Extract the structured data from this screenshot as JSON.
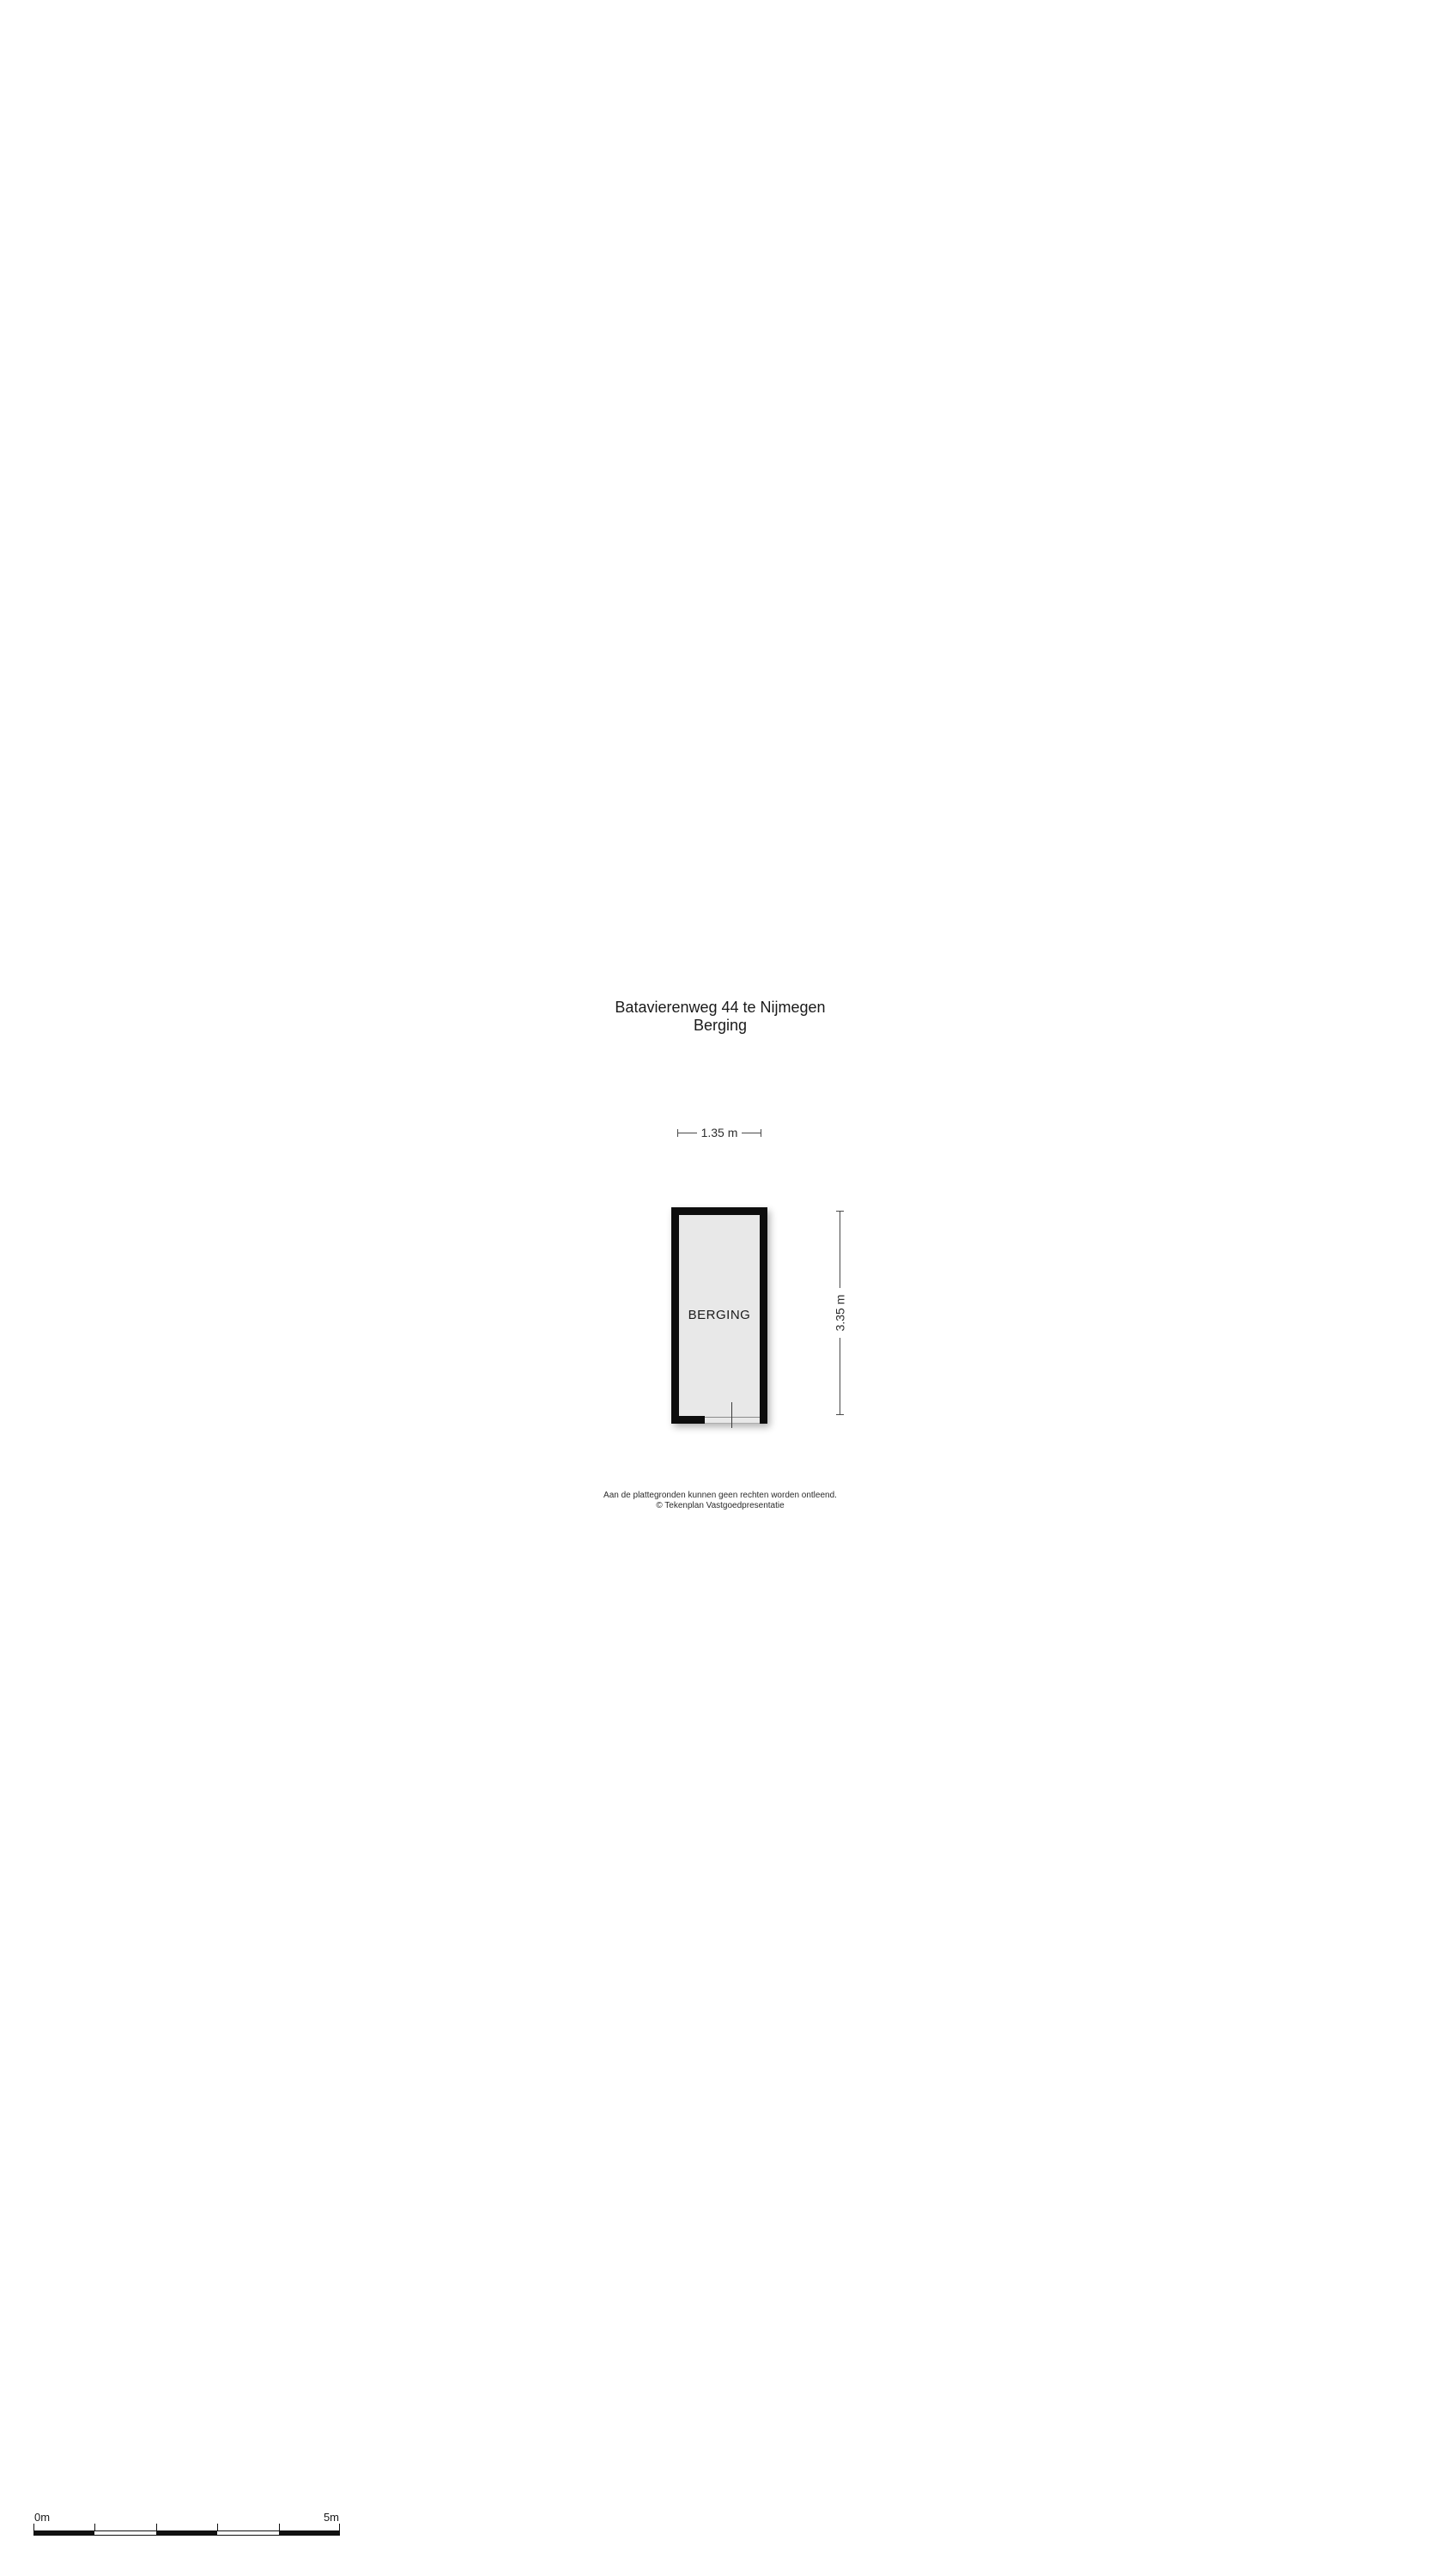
{
  "document": {
    "background": "#ffffff"
  },
  "title": {
    "line1": "Batavierenweg 44 te Nijmegen",
    "line2": "Berging"
  },
  "floorplan": {
    "room": {
      "label": "BERGING",
      "floor_color": "#e8e8e8",
      "wall_color": "#0d0d0d"
    },
    "dimensions": {
      "width_label": "1.35 m",
      "height_label": "3.35 m"
    }
  },
  "footer": {
    "disclaimer_line1": "Aan de plattegronden kunnen geen rechten worden ontleend.",
    "disclaimer_line2": "© Tekenplan Vastgoedpresentatie"
  },
  "scale_bar": {
    "start_label": "0m",
    "end_label": "5m",
    "segments": 5,
    "color": "#111111"
  }
}
